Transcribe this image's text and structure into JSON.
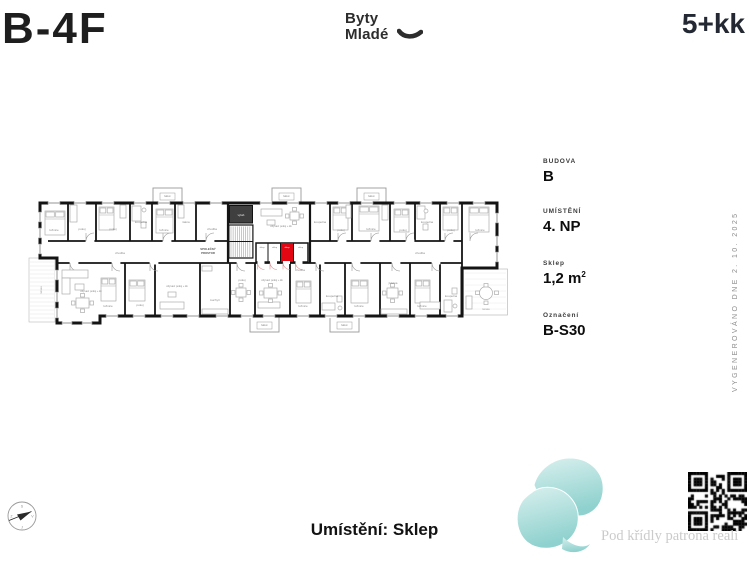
{
  "header": {
    "unit_code": "B-4F",
    "brand_line1": "Byty",
    "brand_line2": "Mladé",
    "layout": "5+kk"
  },
  "info_panel": {
    "items": [
      {
        "label": "BUDOVA",
        "value": "B"
      },
      {
        "label": "UMÍSTĚNÍ",
        "value": "4. NP"
      },
      {
        "label": "Sklep",
        "value": "1,2 m",
        "sup": "2"
      },
      {
        "label": "Označení",
        "value": "B-S30"
      }
    ]
  },
  "generated_note": "VYGENEROVÁNO DNE 2. 10. 2025",
  "footer": {
    "location_label": "Umístění: Sklep",
    "watermark": "Pod křídly patrona reali"
  },
  "compass": {
    "north": "S",
    "east": "V",
    "south": "J",
    "west": "Z"
  },
  "floorplan": {
    "highlight_color": "#e30613",
    "highlighted_unit": "B-S30",
    "room_labels": [
      {
        "t": "ložnice",
        "x": 54,
        "y": 231
      },
      {
        "t": "pokoj",
        "x": 82,
        "y": 230
      },
      {
        "t": "pokoj",
        "x": 113,
        "y": 230
      },
      {
        "t": "koupelna",
        "x": 141,
        "y": 223
      },
      {
        "t": "ložnice",
        "x": 164,
        "y": 231
      },
      {
        "t": "šatna",
        "x": 186,
        "y": 223
      },
      {
        "t": "chodba",
        "x": 212,
        "y": 230
      },
      {
        "t": "obývací pokoj + kk",
        "x": 281,
        "y": 227,
        "s": 2.6
      },
      {
        "t": "koupelna",
        "x": 320,
        "y": 223
      },
      {
        "t": "pokoj",
        "x": 341,
        "y": 231
      },
      {
        "t": "ložnice",
        "x": 371,
        "y": 230
      },
      {
        "t": "pokoj",
        "x": 403,
        "y": 231
      },
      {
        "t": "koupelna",
        "x": 427,
        "y": 223
      },
      {
        "t": "pokoj",
        "x": 451,
        "y": 231
      },
      {
        "t": "ložnice",
        "x": 480,
        "y": 231
      },
      {
        "t": "chodba",
        "x": 120,
        "y": 254
      },
      {
        "t": "chodba",
        "x": 420,
        "y": 254
      },
      {
        "t": "chodba",
        "x": 300,
        "y": 271
      },
      {
        "t": "SPOLEČNÝ",
        "x": 208,
        "y": 250,
        "s": 2.8,
        "w": 700,
        "c": "#555555"
      },
      {
        "t": "PROSTOR",
        "x": 208,
        "y": 254,
        "s": 2.8,
        "w": 700,
        "c": "#555555"
      },
      {
        "t": "výtah",
        "x": 241,
        "y": 216,
        "s": 2.8,
        "c": "#f2f2f2"
      },
      {
        "t": "sklep",
        "x": 262,
        "y": 248,
        "s": 2.2,
        "c": "#777777"
      },
      {
        "t": "sklep",
        "x": 274.5,
        "y": 248,
        "s": 2.2,
        "c": "#777777"
      },
      {
        "t": "sklep",
        "x": 287,
        "y": 248,
        "s": 2.2,
        "c": "#ffffff"
      },
      {
        "t": "sklep",
        "x": 300.5,
        "y": 248,
        "s": 2.2,
        "c": "#777777"
      },
      {
        "t": "obývací pokoj + kk",
        "x": 91,
        "y": 292,
        "s": 2.6
      },
      {
        "t": "ložnice",
        "x": 108,
        "y": 307
      },
      {
        "t": "pokoj",
        "x": 140,
        "y": 306
      },
      {
        "t": "obývací pokoj + kk",
        "x": 177,
        "y": 287,
        "s": 2.6
      },
      {
        "t": "kuchyň",
        "x": 215,
        "y": 301
      },
      {
        "t": "pokoj",
        "x": 242,
        "y": 281
      },
      {
        "t": "obývací pokoj + kk",
        "x": 272,
        "y": 281,
        "s": 2.6
      },
      {
        "t": "ložnice",
        "x": 303,
        "y": 307
      },
      {
        "t": "koupelna",
        "x": 332,
        "y": 297
      },
      {
        "t": "ložnice",
        "x": 359,
        "y": 307
      },
      {
        "t": "jídelna",
        "x": 393,
        "y": 284
      },
      {
        "t": "ložnice",
        "x": 422,
        "y": 307
      },
      {
        "t": "koupelna",
        "x": 451,
        "y": 297
      },
      {
        "t": "balkon",
        "x": 167.5,
        "y": 197,
        "s": 2.3,
        "c": "#888888"
      },
      {
        "t": "balkon",
        "x": 286.5,
        "y": 197,
        "s": 2.3,
        "c": "#888888"
      },
      {
        "t": "balkon",
        "x": 371.5,
        "y": 197,
        "s": 2.3,
        "c": "#888888"
      },
      {
        "t": "balkon",
        "x": 264.5,
        "y": 326,
        "s": 2.3,
        "c": "#888888"
      },
      {
        "t": "balkon",
        "x": 344.5,
        "y": 326,
        "s": 2.3,
        "c": "#888888"
      },
      {
        "t": "terasa",
        "x": 486,
        "y": 310,
        "s": 2.6,
        "c": "#999999"
      },
      {
        "t": "terasa",
        "x": 42,
        "y": 290,
        "s": 2.6,
        "c": "#999999",
        "r": -90
      }
    ]
  }
}
